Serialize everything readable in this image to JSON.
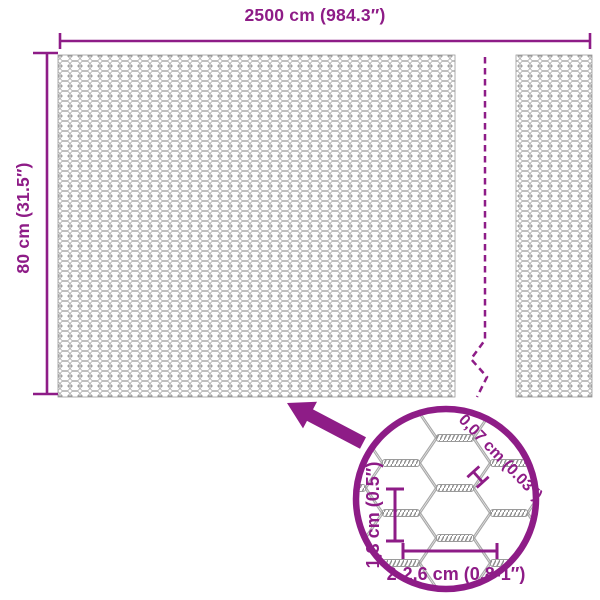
{
  "product_diagram": {
    "roll": {
      "width_label": "2500 cm (984.3″)",
      "height_label": "80 cm (31.5″)"
    },
    "detail_view": {
      "wire_thickness_label": "0,07 cm (0.03″)",
      "cell_height_label": "1,3 cm (0.5″)",
      "cell_width_label": "2-2,6 cm (0.8-1″)"
    },
    "colors": {
      "accent_purple": "#8E1C87",
      "wire_gray": "#9A9A9A",
      "background": "#FFFFFF"
    }
  }
}
